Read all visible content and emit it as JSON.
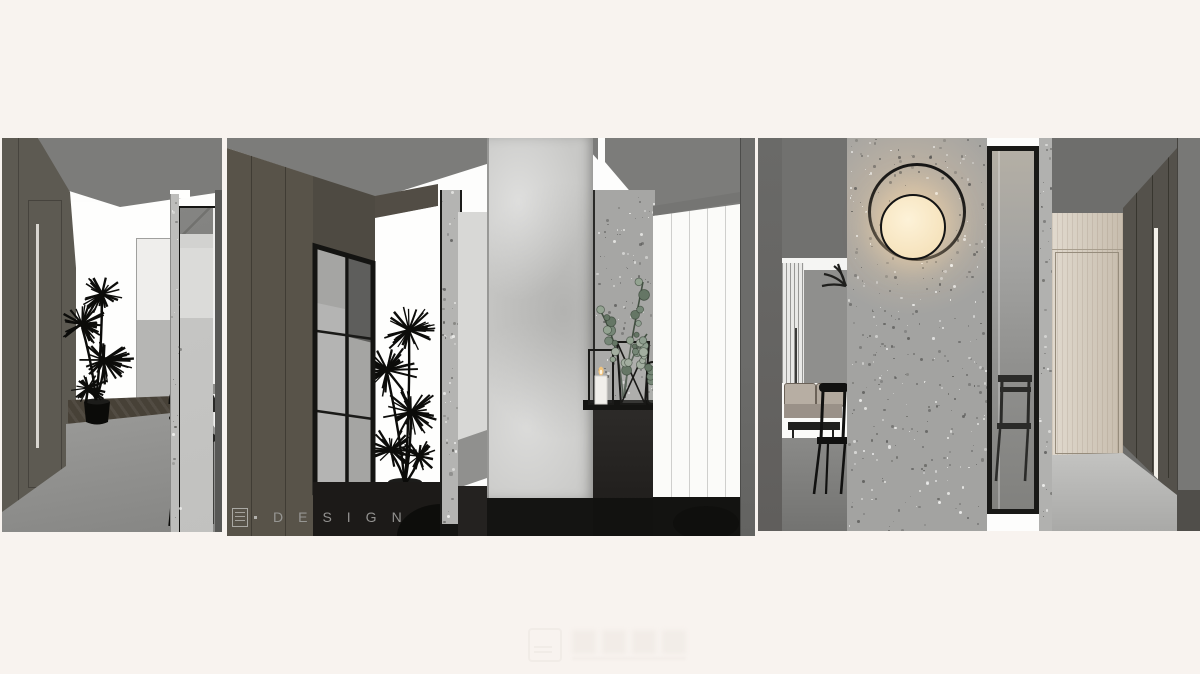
{
  "scene": {
    "watermark_studio": "DESIGN"
  },
  "colors": {
    "page_background": "#f8f3ef",
    "ceiling_gray": "#7c7c7a",
    "wall_taupe": "#5d5a52",
    "wood_dark": "#585349",
    "concrete_light": "#c9c9c7",
    "terrazzo_gray": "#a3a3a1",
    "slat_white": "#fbfbf9",
    "lamp_warm": "#f8e9c6",
    "leaf_green": "#8e9e90",
    "door_wood": "#d6ccbd",
    "silhouette_black": "#131311"
  }
}
